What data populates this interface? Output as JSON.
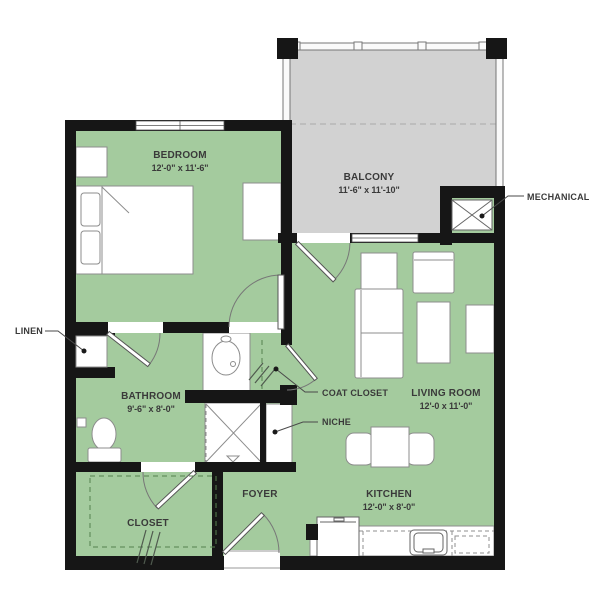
{
  "plan": {
    "type": "apartment-floor-plan",
    "colors": {
      "floor_green": "#a4cb9e",
      "balcony_gray": "#d2d2d2",
      "wall_black": "#161616",
      "fixture_white": "#ffffff",
      "label_text": "#3a3a3a"
    },
    "rooms": {
      "bedroom": {
        "name": "BEDROOM",
        "dims": "12'-0\" x 11'-6\""
      },
      "balcony": {
        "name": "BALCONY",
        "dims": "11'-6\" x 11'-10\""
      },
      "living_room": {
        "name": "LIVING ROOM",
        "dims": "12'-0 x 11'-0\""
      },
      "bathroom": {
        "name": "BATHROOM",
        "dims": "9'-6\" x 8'-0\""
      },
      "kitchen": {
        "name": "KITCHEN",
        "dims": "12'-0\" x 8'-0\""
      },
      "foyer": {
        "name": "FOYER"
      },
      "closet": {
        "name": "CLOSET"
      }
    },
    "callouts": {
      "mechanical": {
        "label": "MECHANICAL"
      },
      "linen": {
        "label": "LINEN"
      },
      "coat_closet": {
        "label": "COAT CLOSET"
      },
      "niche": {
        "label": "NICHE"
      }
    }
  }
}
